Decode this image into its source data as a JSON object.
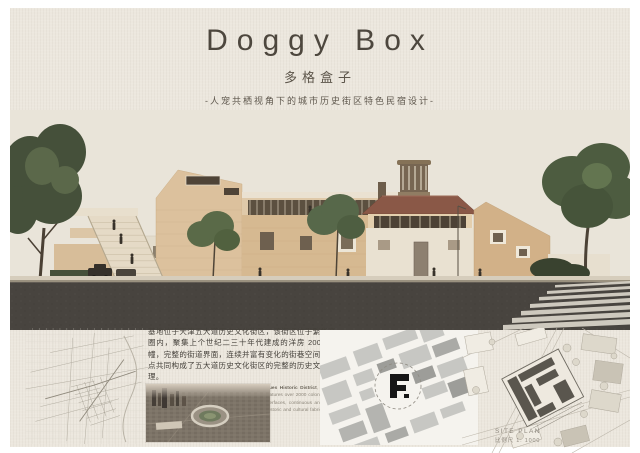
{
  "header": {
    "title": "Doggy Box",
    "subtitle": "多格盒子",
    "tagline": "-人宠共栖视角下的城市历史街区特色民宿设计-"
  },
  "description": {
    "cn": "基地位于天津五大道历史文化街区，该街区位于繁华商圈内，聚集上个世纪二三十年代建成的洋房 2000 多幢，完整的街道界面，连续并富有变化的街巷空间等特点共同构成了五大道历史文化街区的完整的历史文化肌理。",
    "en_lead": "The site is situated within ",
    "en_bold": "Tianjin's Five Great Avenues Historic District",
    "en_rest": ", located inside the former Great Britain Concession. The area features over 2000 colonial-style villas built during the 1920s-1930s. Its intact street interfaces, continuous and richly varied street spaces together constitute the integrated historic and cultural fabric of the Five Great Avenues Historic District."
  },
  "site_plan": {
    "label": "SITE PLAN",
    "scale": "比例尺 1: 1000"
  },
  "colors": {
    "paper": "#ece7de",
    "sky": "#e9e4d9",
    "brick": "#d6b991",
    "roof_red": "#8a5847",
    "asphalt": "#48443f",
    "tree_dark": "#45503a",
    "tree_light": "#5a6a48",
    "map_line": "#b3ada1",
    "figure_block": "#c7c7c3",
    "site_black": "#161616"
  }
}
